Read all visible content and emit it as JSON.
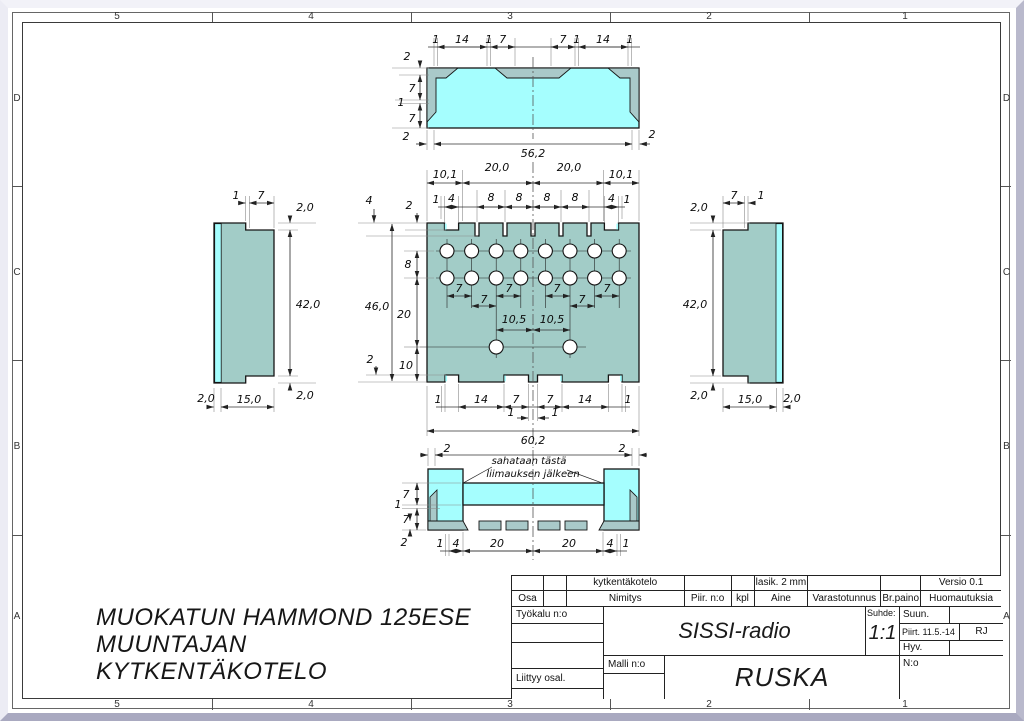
{
  "colors": {
    "part_cyan": "#A5FEFE",
    "part_teal": "#A2CCC7",
    "part_shadow_teal": "#A9C9C9",
    "desk_background": "#C9C9DB",
    "line": "#111111"
  },
  "zones": {
    "columns": [
      "5",
      "4",
      "3",
      "2",
      "1"
    ],
    "rows": [
      "D",
      "C",
      "B",
      "A"
    ]
  },
  "note": {
    "line1": "MUOKATUN HAMMOND 125ESE",
    "line2": "MUUNTAJAN KYTKENTÄKOTELO"
  },
  "views": {
    "top": {
      "dims_top": [
        "1",
        "14",
        "1",
        "7",
        "7",
        "1",
        "14",
        "1"
      ],
      "dims_left": [
        "2",
        "7",
        "1",
        "7"
      ],
      "dim_bottom_left": "2",
      "dim_bottom_right": "2",
      "dim_width": "56,2"
    },
    "main": {
      "dims_span": [
        "10,1",
        "20,0",
        "20,0",
        "10,1"
      ],
      "dims_slots": [
        "1",
        "4",
        "8",
        "8",
        "8",
        "8",
        "4",
        "1"
      ],
      "dim_slot_depth": "4",
      "dim_height": "46,0",
      "dim_notch_bottom": "2",
      "dims_left": [
        "2",
        "8",
        "20",
        "10"
      ],
      "dims_holes": [
        "7",
        "7",
        "7",
        "7",
        "7",
        "7"
      ],
      "dims_center": [
        "10,5",
        "10,5"
      ],
      "dims_bottom": [
        "1",
        "14",
        "7",
        "7",
        "14",
        "1"
      ],
      "dims_bottom_small": [
        "1",
        "1"
      ],
      "dim_width": "60,2"
    },
    "left": {
      "dims_top": [
        "1",
        "7"
      ],
      "dim_top_right": "2,0",
      "dim_height": "42,0",
      "dim_bottom_right": "2,0",
      "dim_bottom_left": "2,0",
      "dim_body": "15,0"
    },
    "right": {
      "dims_top": [
        "7",
        "1"
      ],
      "dim_top_left": "2,0",
      "dim_height": "42,0",
      "dim_bottom_left": "2,0",
      "dim_body": "15,0",
      "dim_bottom_right": "2,0"
    },
    "bottom": {
      "dim_left": "2",
      "dim_right": "2",
      "dims_side": [
        "7",
        "1",
        "7",
        "2"
      ],
      "dims_bottom": [
        "1",
        "4",
        "20",
        "20",
        "4",
        "1"
      ],
      "callout1": "sahataan tästä",
      "callout2": "liimauksen jälkeen"
    }
  },
  "title_block": {
    "part_name": "kytkentäkotelo",
    "material_value": "lasik. 2 mm",
    "version": "Versio 0.1",
    "headers": [
      "Osa",
      "Nimitys",
      "Piir. n:o",
      "kpl",
      "Aine",
      "Varastotunnus",
      "Br.paino",
      "Huomautuksia"
    ],
    "tool_label": "Työkalu n:o",
    "related_label": "Liittyy osal.",
    "model_label": "Malli n:o",
    "project": "SISSI-radio",
    "scale_label": "Suhde:",
    "scale_value": "1:1",
    "designed_label": "Suun.",
    "drawn_label": "Piirt. 11.5.-14",
    "drawn_by": "RJ",
    "approved_label": "Hyv.",
    "number_label": "N:o",
    "product": "RUSKA"
  }
}
